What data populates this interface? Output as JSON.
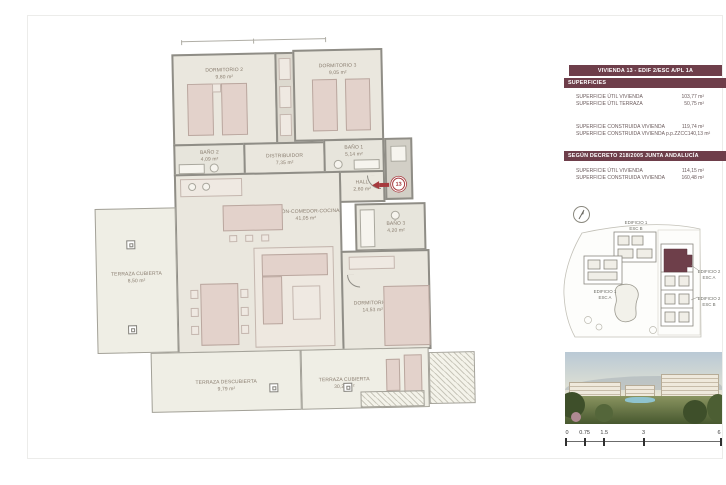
{
  "panel": {
    "title": "VIVIENDA 13 - EDIF 2/ESC A/PL 1A",
    "section1_header": "SUPERFICIES",
    "rows1": [
      {
        "label": "SUPERFICIE ÚTIL VIVIENDA",
        "value": "103,77 m²"
      },
      {
        "label": "SUPERFICIE ÚTIL TERRAZA",
        "value": "50,75 m²"
      }
    ],
    "rows2": [
      {
        "label": "SUPERFICIE CONSTRUIDA VIVIENDA",
        "value": "119,74 m²"
      },
      {
        "label": "SUPERFICIE CONSTRUIDA VIVIENDA p.p.ZZCC",
        "value": "140,13 m²"
      }
    ],
    "section2_header": "SEGÚN DECRETO 218/2005 JUNTA ANDALUCÍA",
    "rows3": [
      {
        "label": "SUPERFICIE ÚTIL VIVIENDA",
        "value": "114,15 m²"
      },
      {
        "label": "SUPERFICIE CONSTRUIDA VIVIENDA",
        "value": "160,48 m²"
      }
    ]
  },
  "floorplan": {
    "unit_marker": "13",
    "rooms": {
      "dormitorio2": {
        "name": "DORMITORIO 2",
        "area": "9,80 m²"
      },
      "dormitorio3": {
        "name": "DORMITORIO 3",
        "area": "9,05 m²"
      },
      "bano2": {
        "name": "BAÑO 2",
        "area": "4,09 m²"
      },
      "bano1": {
        "name": "BAÑO 1",
        "area": "5,14 m²"
      },
      "distribuidor": {
        "name": "DISTRIBUIDOR",
        "area": "7,35 m²"
      },
      "hall": {
        "name": "HALL",
        "area": "2,60 m²"
      },
      "salon": {
        "name": "SALÓN-COMEDOR-COCINA",
        "area": "41,05 m²"
      },
      "bano3": {
        "name": "BAÑO 3",
        "area": "4,20 m²"
      },
      "dormitorio1": {
        "name": "DORMITORIO 1",
        "area": "14,53 m²"
      },
      "terraza_cubierta_oeste": {
        "name": "TERRAZA CUBIERTA",
        "area": "8,50 m²"
      },
      "terraza_descubierta": {
        "name": "TERRAZA DESCUBIERTA",
        "area": "9,79 m²"
      },
      "terraza_cubierta_sur": {
        "name": "TERRAZA CUBIERTA",
        "area": "30,21 m²"
      }
    }
  },
  "siteplan": {
    "labels": [
      {
        "line1": "EDIFICIO 1",
        "line2": "ESC B"
      },
      {
        "line1": "EDIFICIO 1",
        "line2": "ESC A"
      },
      {
        "line1": "EDIFICIO 2",
        "line2": "ESC A"
      },
      {
        "line1": "EDIFICIO 2",
        "line2": "ESC B"
      }
    ]
  },
  "scalebar": {
    "ticks": [
      "0",
      "0.75",
      "1.5",
      "3",
      "6"
    ]
  },
  "colors": {
    "accent": "#6e3e4a",
    "marker_red": "#a63a3e",
    "wall_gray": "#8f8d86"
  }
}
